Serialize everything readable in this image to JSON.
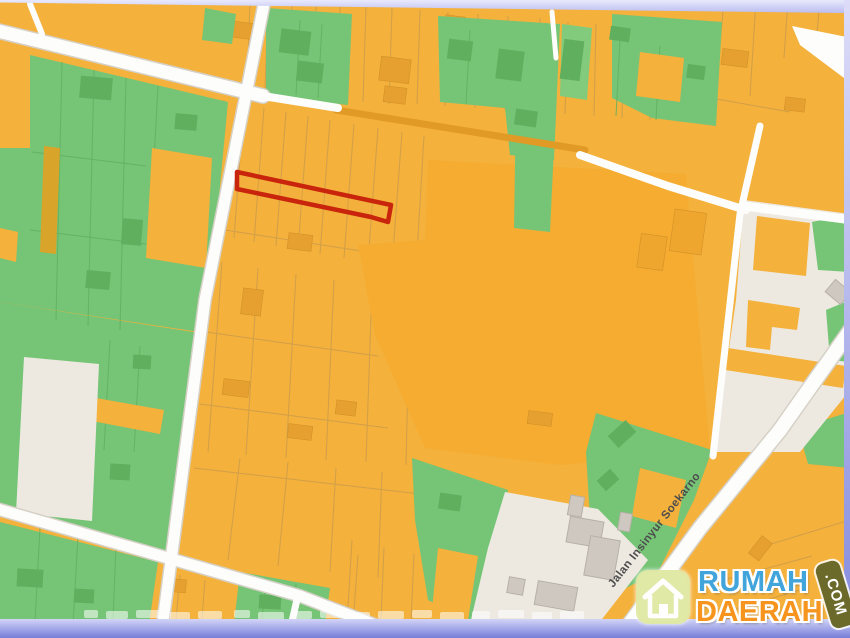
{
  "map": {
    "type": "cadastral-zoning-map",
    "road_label": "Jalan Insinyur Soekarno",
    "highlighted_parcel": {
      "description": "long narrow parcel outlined in red",
      "outline_color": "#c8250c"
    },
    "zone_colors": {
      "parcel_orange": "#f4b13c",
      "parcel_orange_deep": "#f5ac31",
      "green_zone": "#76c476",
      "green_zone_dark": "#5faf5f",
      "open_land_beige": "#ede9e1",
      "building_gray": "#cfc8c1",
      "road_white": "#fdfdfb"
    }
  },
  "watermark": {
    "brand_line1": "RUMAH",
    "brand_line2": "DAERAH",
    "badge": ".COM",
    "colors": {
      "line1": "#41a5dc",
      "line2": "#f7941e",
      "badge_bg": "#6b6a2b",
      "house_icon_bg": "#dfe7a0"
    }
  },
  "frame": {
    "top": "#c9cbf4",
    "right": "#abafe9",
    "bottom": "#767ed8"
  }
}
